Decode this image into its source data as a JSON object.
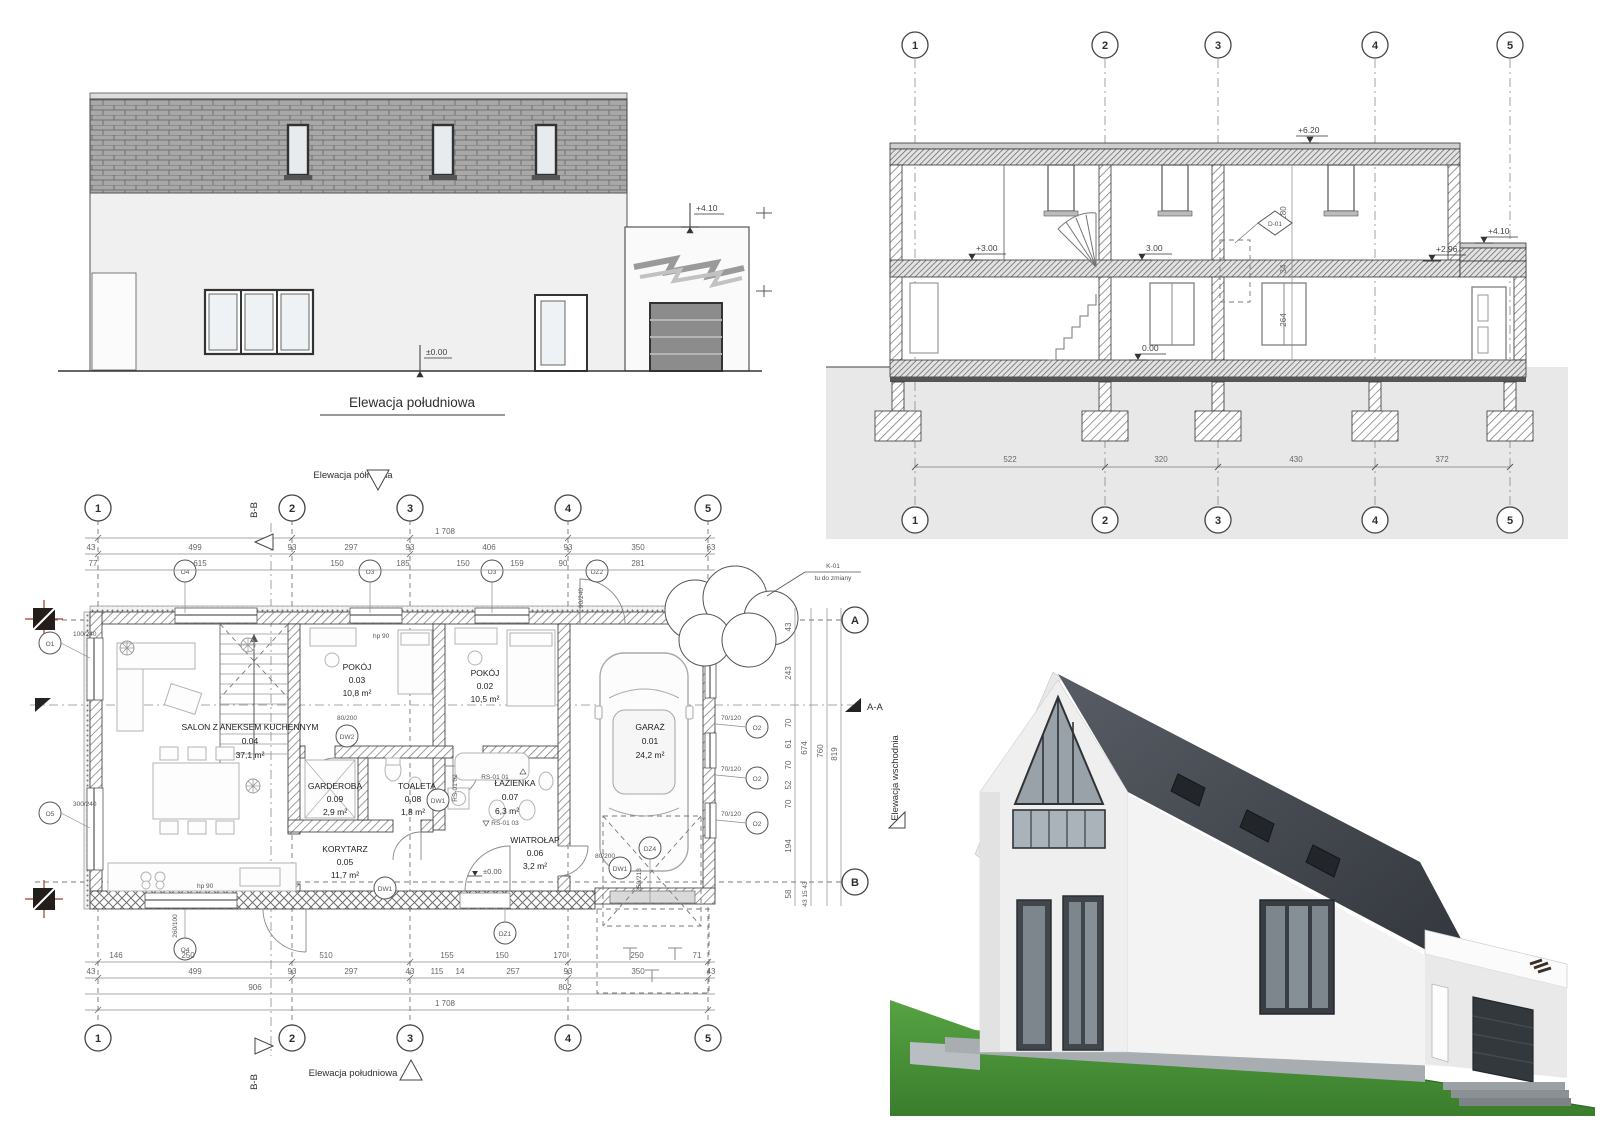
{
  "titles": {
    "elev_south": "Elewacja południowa",
    "elev_north": "Elewacja północna",
    "elev_east": "Elewacja wschodnia",
    "section_aa": "A-A",
    "section_bb": "B-B"
  },
  "elevation": {
    "level_top": "+4.10",
    "level_zero": "±0.00"
  },
  "section": {
    "grids": [
      "1",
      "2",
      "3",
      "4",
      "5"
    ],
    "levels": {
      "roof": "+6.20",
      "annex_top": "+4.10",
      "floor2_left": "+3.00",
      "floor2_mid": "3.00",
      "annex_floor": "+2.96",
      "zero": "0.00"
    },
    "vdims": {
      "upper": "280",
      "slab": "34",
      "lower": "264"
    },
    "tag": "D-01",
    "hdims": [
      "522",
      "320",
      "430",
      "372"
    ]
  },
  "plan": {
    "grids": [
      "1",
      "2",
      "3",
      "4",
      "5"
    ],
    "rows": {
      "a": "A",
      "b": "B"
    },
    "rooms": [
      {
        "name": "SALON Z ANEKSEM KUCHENNYM",
        "num": "0.04",
        "area": "37,1 m²"
      },
      {
        "name": "POKÓJ",
        "num": "0.03",
        "area": "10,8 m²"
      },
      {
        "name": "POKÓJ",
        "num": "0.02",
        "area": "10,5 m²"
      },
      {
        "name": "GARAŻ",
        "num": "0.01",
        "area": "24,2 m²"
      },
      {
        "name": "GARDEROBA",
        "num": "0.09",
        "area": "2,9 m²"
      },
      {
        "name": "TOALETA",
        "num": "0.08",
        "area": "1,8 m²"
      },
      {
        "name": "ŁAZIENKA",
        "num": "0.07",
        "area": "6,3 m²"
      },
      {
        "name": "KORYTARZ",
        "num": "0.05",
        "area": "11,7 m²"
      },
      {
        "name": "WIATROŁAP",
        "num": "0.06",
        "area": "3,2 m²"
      }
    ],
    "level_zero": "±0.00",
    "dims_top": {
      "overall": "1 708",
      "row2": [
        "43",
        "499",
        "93",
        "297",
        "93",
        "406",
        "93",
        "350",
        "63"
      ],
      "row3": [
        "77",
        "615",
        "150",
        "185",
        "150",
        "159",
        "90",
        "281"
      ]
    },
    "dims_bottom": {
      "row1": [
        "146",
        "250",
        "510",
        "155",
        "150",
        "170",
        "250",
        "71"
      ],
      "row2": [
        "43",
        "499",
        "93",
        "297",
        "43",
        "115",
        "14",
        "257",
        "93",
        "350",
        "43"
      ],
      "row3": [
        "906",
        "802"
      ],
      "overall": "1 708"
    },
    "dims_right": {
      "segs": [
        "43",
        "243",
        "70",
        "61",
        "70",
        "52",
        "70",
        "194",
        "58"
      ],
      "totals": [
        "674",
        "760",
        "819"
      ],
      "bottom": "43 15 43"
    },
    "markers": {
      "o4t": "O4",
      "o3a": "O3",
      "o3b": "O3",
      "dz2": "DZ2",
      "o1": "O1",
      "o5": "O5",
      "o4b": "O4",
      "o2": "O2",
      "dw1": "DW1",
      "dw2": "DW2",
      "dz1": "DZ1",
      "dz4": "DZ4"
    },
    "tags": {
      "o1": "100/240",
      "o5": "300/240",
      "o4b": "260/100",
      "o2": "70/120",
      "dz2": "90/240",
      "dw": "90/200",
      "dw2": "80/200",
      "dz4": "250/213",
      "hp": "hp 90"
    },
    "rs": [
      "RS-01 01",
      "RS-01 02",
      "RS-01 03"
    ],
    "tree_note_1": "K-01",
    "tree_note_2": "tu do zmiany"
  },
  "colors": {
    "paper": "#ffffff",
    "line": "#3a3a3a",
    "ground": "#e8e8e8",
    "roof3d": "#3b3f46",
    "grass": "#4a9038"
  }
}
